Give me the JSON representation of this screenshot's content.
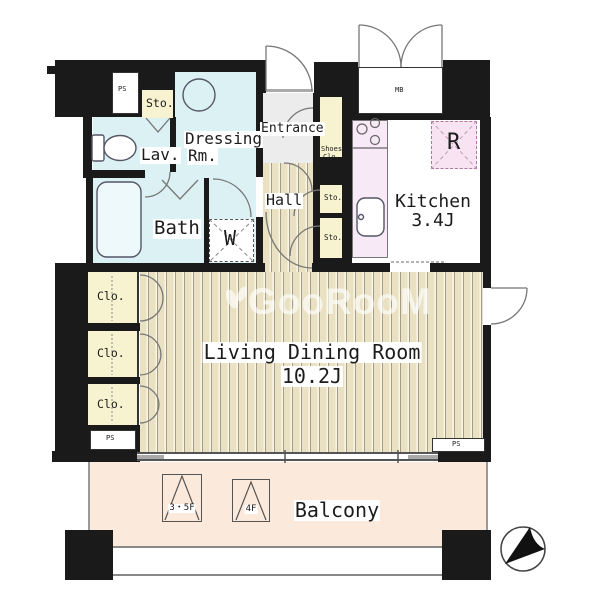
{
  "watermark": {
    "text": "GooRooM"
  },
  "rooms": {
    "living": {
      "name": "Living Dining Room",
      "size": "10.2J"
    },
    "kitchen": {
      "name": "Kitchen",
      "size": "3.4J"
    },
    "balcony": {
      "name": "Balcony"
    },
    "hall": {
      "name": "Hall"
    },
    "entrance": {
      "name": "Entrance"
    },
    "bath": {
      "name": "Bath"
    },
    "lavatory": {
      "name": "Lav."
    },
    "dressing": {
      "name_line1": "Dressing",
      "name_line2": "Rm."
    }
  },
  "storage": {
    "sto_top": "Sto.",
    "shoes_closet_line1": "Shoes",
    "shoes_closet_line2": "Clo.",
    "sto_mid": "Sto.",
    "sto_lower": "Sto.",
    "closet_1": "Clo.",
    "closet_2": "Clo.",
    "closet_3": "Clo."
  },
  "fixtures": {
    "washer_mark": "W",
    "refrigerator_mark": "R"
  },
  "service": {
    "ps_top": "PS",
    "ps_left": "PS",
    "ps_bottom": "PS",
    "meter_box": "MB"
  },
  "balcony_hatches": {
    "hatch_35f": "3・5F",
    "hatch_4f": "4F"
  },
  "colors": {
    "wall": "#1a1a1a",
    "wet_rooms": "#dcf1f4",
    "storage_cream": "#f7f3d0",
    "floor_wood": "#e9e1c2",
    "kitchen_counter": "#f7e9f6",
    "balcony": "#fbe9db",
    "entrance_floor": "#ececec",
    "refrigerator_fill": "#f7e3f2"
  }
}
